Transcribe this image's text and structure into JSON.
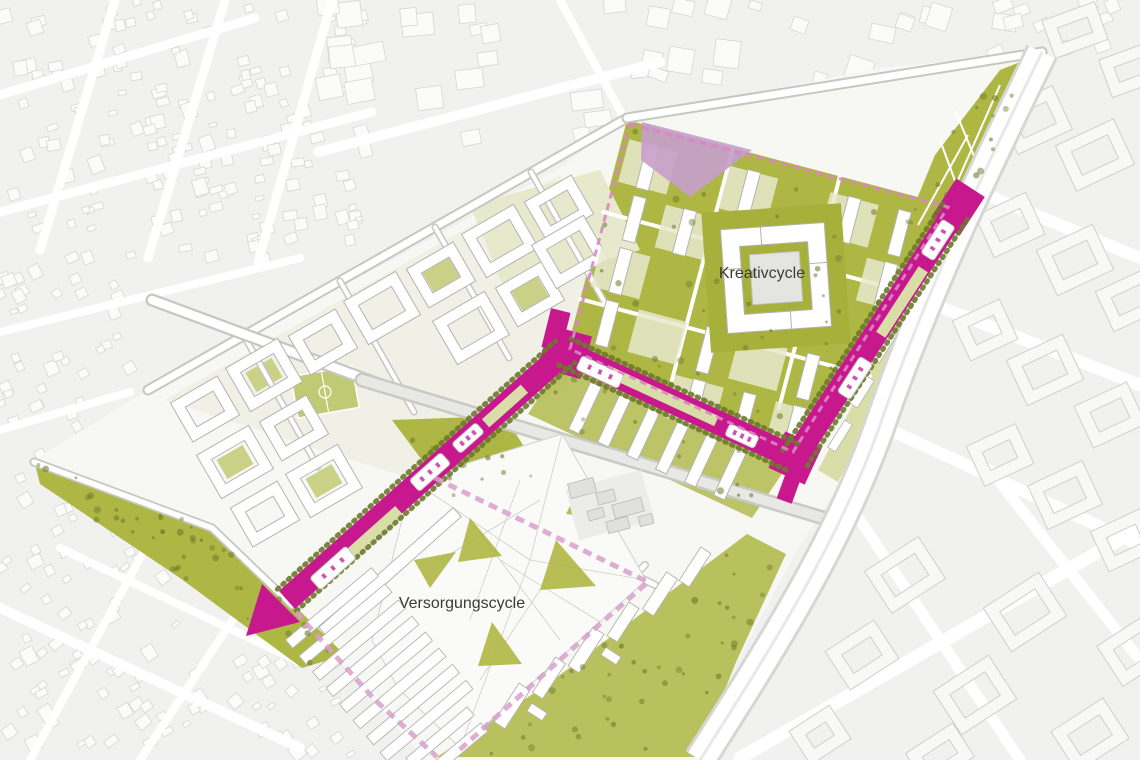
{
  "map": {
    "type": "urban-masterplan",
    "labels": {
      "kreativ": "Kreativcycle",
      "versorgung": "Versorgungscycle"
    },
    "colors": {
      "background": "#f1f1ef",
      "ctx_fill": "#fbfbf9",
      "ctx_stroke": "#d6d6d3",
      "site": "#f7f7f4",
      "site_pale": "#ededdf",
      "green": "#aeb743",
      "green_mid": "#c5cd7c",
      "green_light": "#d9dea8",
      "green_pale": "#e7e9cc",
      "green_dark": "#6d7a2c",
      "pitch": "#bfca74",
      "magenta": "#c7188e",
      "pink": "#d8a0cb",
      "pink_dash": "#dc85c6",
      "lilac": "#c79fcc",
      "bld": "#ffffff",
      "bld_stroke": "#b3b3af",
      "gray_bld": "#e0e0dd",
      "gray_bld_stroke": "#b9b9b5",
      "gray_yard": "#ececea",
      "street_case": "#c6c6c2",
      "street_wide": "#e8e8e5",
      "street_white": "#ffffff",
      "label": "#3b3b39"
    }
  }
}
